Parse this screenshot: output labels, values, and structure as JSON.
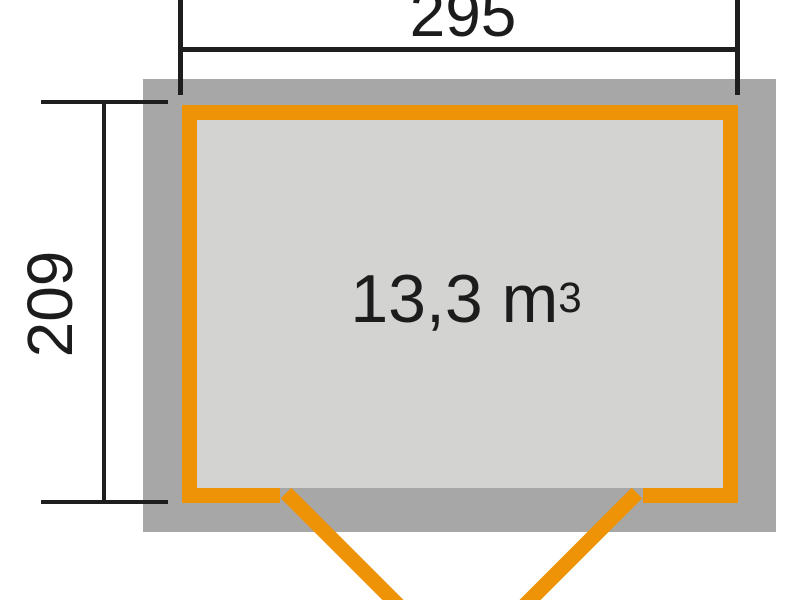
{
  "diagram": {
    "type": "shed-floor-plan",
    "width_label": "295",
    "depth_label": "209",
    "volume": {
      "base": "13,3 m",
      "exponent": "3"
    }
  },
  "colors": {
    "accent_orange": "#ee9206",
    "wall_gray": "#a7a7a7",
    "floor_gray": "#d3d3d1",
    "line_black": "#1e1e1e"
  }
}
